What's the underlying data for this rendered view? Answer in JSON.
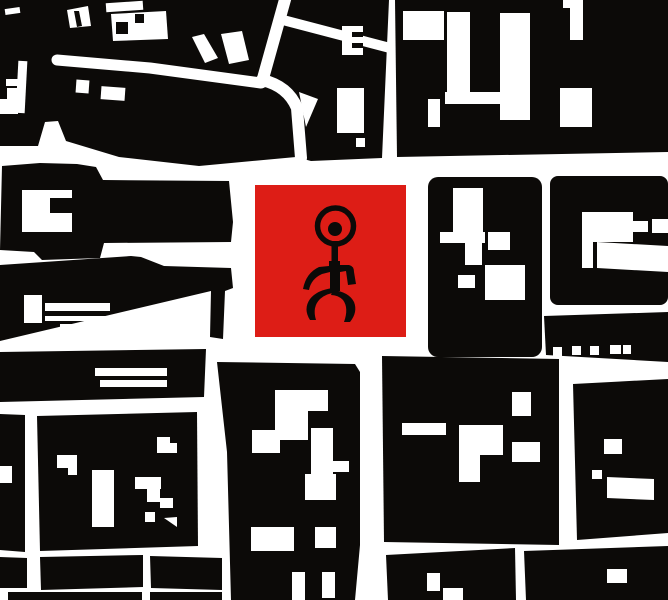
{
  "scene": {
    "width": 668,
    "height": 600,
    "background": "#ffffff",
    "ink": "#0c0a08",
    "marker_red": "#dd1d16",
    "description": "Black-and-white stylized city block map with red square marker bearing the Einstuerzende Neubauten stick-figure symbol"
  },
  "marker": {
    "x": 255,
    "y": 185,
    "w": 151,
    "h": 152
  },
  "map": {
    "blacks": [
      {
        "t": "p",
        "pts": "0,0 389,0 382,158 311,161 296,157 199,166 119,157 66,141 58,121 45,122 38,146 0,146"
      },
      {
        "t": "p",
        "pts": "395,0 668,0 668,152 397,157"
      },
      {
        "t": "p",
        "pts": "2,166 40,163 77,164 96,167 103,180 229,181 233,222 231,242 104,243 100,258 42,260 34,252 0,250"
      },
      {
        "t": "p",
        "pts": "0,265 131,256 141,257 164,266 231,268 233,288 225,291 223,339 210,337 211,291 0,341"
      },
      {
        "t": "p",
        "pts": "0,352 206,349 204,397 0,402"
      },
      {
        "t": "p",
        "pts": "0,414 25,415 25,552 0,550"
      },
      {
        "t": "p",
        "pts": "37,416 197,412 198,546 40,551"
      },
      {
        "t": "p",
        "pts": "40,557 143,555 143,587 41,590"
      },
      {
        "t": "p",
        "pts": "150,556 222,558 222,590 151,588"
      },
      {
        "t": "p",
        "pts": "0,557 27,558 27,588 0,588"
      },
      {
        "t": "r",
        "x": 8,
        "y": 592,
        "w": 134,
        "h": 8
      },
      {
        "t": "r",
        "x": 150,
        "y": 592,
        "w": 72,
        "h": 8
      },
      {
        "t": "p",
        "pts": "217,362 355,364 360,372 360,545 355,600 231,600 227,452"
      },
      {
        "t": "p",
        "pts": "382,356 559,359 559,545 384,542"
      },
      {
        "t": "p",
        "pts": "386,555 515,548 516,600 388,600"
      },
      {
        "t": "r",
        "x": 428,
        "y": 177,
        "w": 114,
        "h": 180,
        "rx": 10
      },
      {
        "t": "r",
        "x": 550,
        "y": 176,
        "w": 118,
        "h": 129,
        "rx": 8
      },
      {
        "t": "p",
        "pts": "544,316 668,312 668,362 546,355"
      },
      {
        "t": "p",
        "pts": "573,384 668,379 668,533 577,540"
      },
      {
        "t": "p",
        "pts": "524,551 668,546 668,600 526,600"
      }
    ],
    "whites": [
      {
        "t": "r",
        "x": 5,
        "y": 8,
        "w": 15,
        "h": 6,
        "rot": -8
      },
      {
        "t": "p",
        "pts": "67,10 88,6 91,26 70,28"
      },
      {
        "t": "r",
        "x": 106,
        "y": 2,
        "w": 37,
        "h": 9,
        "rot": -4
      },
      {
        "t": "p",
        "pts": "111,14 166,11 168,39 113,41"
      },
      {
        "t": "r",
        "x": 17,
        "y": 61,
        "w": 9,
        "h": 52,
        "rot": 3
      },
      {
        "t": "r",
        "x": 6,
        "y": 79,
        "w": 13,
        "h": 7
      },
      {
        "t": "r",
        "x": 7,
        "y": 88,
        "w": 16,
        "h": 13
      },
      {
        "t": "r",
        "x": 0,
        "y": 99,
        "w": 18,
        "h": 15
      },
      {
        "t": "s",
        "d": "M 57 60 L 150 68 L 261 83",
        "w": 11
      },
      {
        "t": "s",
        "d": "M 286 -4 L 262 82",
        "w": 12
      },
      {
        "t": "s",
        "d": "M 283 20 L 390 48",
        "w": 10
      },
      {
        "t": "s",
        "d": "M 262 80 Q 288 86 297 108 L 301 158",
        "w": 12
      },
      {
        "t": "p",
        "pts": "299,92 318,99 306,127"
      },
      {
        "t": "p",
        "pts": "192,37 204,34 218,58 205,63"
      },
      {
        "t": "p",
        "pts": "221,34 242,31 249,60 229,64"
      },
      {
        "t": "r",
        "x": 76,
        "y": 80,
        "w": 13,
        "h": 13,
        "rot": 4
      },
      {
        "t": "r",
        "x": 101,
        "y": 87,
        "w": 24,
        "h": 13,
        "rot": 4
      },
      {
        "t": "r",
        "x": 342,
        "y": 26,
        "w": 21,
        "h": 29
      },
      {
        "t": "r",
        "x": 337,
        "y": 88,
        "w": 27,
        "h": 45
      },
      {
        "t": "r",
        "x": 356,
        "y": 138,
        "w": 9,
        "h": 9
      },
      {
        "t": "r",
        "x": 403,
        "y": 11,
        "w": 41,
        "h": 29
      },
      {
        "t": "r",
        "x": 447,
        "y": 12,
        "w": 23,
        "h": 85
      },
      {
        "t": "r",
        "x": 445,
        "y": 92,
        "w": 65,
        "h": 12
      },
      {
        "t": "r",
        "x": 428,
        "y": 99,
        "w": 12,
        "h": 28
      },
      {
        "t": "r",
        "x": 500,
        "y": 13,
        "w": 30,
        "h": 107
      },
      {
        "t": "r",
        "x": 563,
        "y": 0,
        "w": 20,
        "h": 8
      },
      {
        "t": "r",
        "x": 570,
        "y": 8,
        "w": 13,
        "h": 32
      },
      {
        "t": "r",
        "x": 560,
        "y": 88,
        "w": 32,
        "h": 39
      },
      {
        "t": "p",
        "pts": "22,190 72,190 72,232 22,232"
      },
      {
        "t": "r",
        "x": 24,
        "y": 295,
        "w": 18,
        "h": 28
      },
      {
        "t": "r",
        "x": 45,
        "y": 303,
        "w": 65,
        "h": 8
      },
      {
        "t": "r",
        "x": 45,
        "y": 316,
        "w": 68,
        "h": 5
      },
      {
        "t": "r",
        "x": 60,
        "y": 324,
        "w": 38,
        "h": 4
      },
      {
        "t": "r",
        "x": 95,
        "y": 368,
        "w": 72,
        "h": 8
      },
      {
        "t": "r",
        "x": 100,
        "y": 380,
        "w": 67,
        "h": 7
      },
      {
        "t": "r",
        "x": 0,
        "y": 466,
        "w": 12,
        "h": 17
      },
      {
        "t": "p",
        "pts": "57,455 77,455 77,475 68,475 68,468 57,468"
      },
      {
        "t": "r",
        "x": 92,
        "y": 470,
        "w": 22,
        "h": 57
      },
      {
        "t": "r",
        "x": 135,
        "y": 477,
        "w": 26,
        "h": 12
      },
      {
        "t": "r",
        "x": 147,
        "y": 489,
        "w": 13,
        "h": 13
      },
      {
        "t": "r",
        "x": 145,
        "y": 512,
        "w": 10,
        "h": 10
      },
      {
        "t": "r",
        "x": 160,
        "y": 498,
        "w": 13,
        "h": 10
      },
      {
        "t": "p",
        "pts": "164,518 177,517 177,527"
      },
      {
        "t": "p",
        "pts": "157,437 170,437 170,443 177,443 177,453 157,453"
      },
      {
        "t": "r",
        "x": 252,
        "y": 430,
        "w": 28,
        "h": 23
      },
      {
        "t": "r",
        "x": 275,
        "y": 390,
        "w": 53,
        "h": 21
      },
      {
        "t": "r",
        "x": 275,
        "y": 411,
        "w": 33,
        "h": 29
      },
      {
        "t": "r",
        "x": 311,
        "y": 428,
        "w": 22,
        "h": 47
      },
      {
        "t": "r",
        "x": 333,
        "y": 461,
        "w": 16,
        "h": 11
      },
      {
        "t": "r",
        "x": 305,
        "y": 474,
        "w": 31,
        "h": 26
      },
      {
        "t": "r",
        "x": 251,
        "y": 527,
        "w": 43,
        "h": 24
      },
      {
        "t": "r",
        "x": 315,
        "y": 527,
        "w": 21,
        "h": 21
      },
      {
        "t": "r",
        "x": 292,
        "y": 572,
        "w": 13,
        "h": 28
      },
      {
        "t": "r",
        "x": 322,
        "y": 572,
        "w": 13,
        "h": 26
      },
      {
        "t": "r",
        "x": 402,
        "y": 423,
        "w": 44,
        "h": 12
      },
      {
        "t": "p",
        "pts": "459,425 503,425 503,455 480,455 480,482 459,482"
      },
      {
        "t": "r",
        "x": 512,
        "y": 392,
        "w": 19,
        "h": 24
      },
      {
        "t": "r",
        "x": 512,
        "y": 442,
        "w": 28,
        "h": 20
      },
      {
        "t": "r",
        "x": 427,
        "y": 573,
        "w": 13,
        "h": 18
      },
      {
        "t": "r",
        "x": 443,
        "y": 588,
        "w": 20,
        "h": 12
      },
      {
        "t": "r",
        "x": 453,
        "y": 188,
        "w": 30,
        "h": 46
      },
      {
        "t": "r",
        "x": 440,
        "y": 232,
        "w": 45,
        "h": 11
      },
      {
        "t": "r",
        "x": 465,
        "y": 243,
        "w": 17,
        "h": 22
      },
      {
        "t": "r",
        "x": 488,
        "y": 232,
        "w": 22,
        "h": 18
      },
      {
        "t": "r",
        "x": 485,
        "y": 265,
        "w": 40,
        "h": 35
      },
      {
        "t": "r",
        "x": 458,
        "y": 275,
        "w": 17,
        "h": 13
      },
      {
        "t": "r",
        "x": 582,
        "y": 212,
        "w": 51,
        "h": 30
      },
      {
        "t": "r",
        "x": 633,
        "y": 221,
        "w": 15,
        "h": 11
      },
      {
        "t": "r",
        "x": 652,
        "y": 219,
        "w": 16,
        "h": 14
      },
      {
        "t": "r",
        "x": 582,
        "y": 242,
        "w": 11,
        "h": 26
      },
      {
        "t": "p",
        "pts": "597,242 668,246 668,272 597,268"
      },
      {
        "t": "r",
        "x": 553,
        "y": 347,
        "w": 9,
        "h": 9
      },
      {
        "t": "r",
        "x": 572,
        "y": 346,
        "w": 9,
        "h": 9
      },
      {
        "t": "r",
        "x": 590,
        "y": 346,
        "w": 9,
        "h": 9
      },
      {
        "t": "r",
        "x": 610,
        "y": 345,
        "w": 11,
        "h": 9
      },
      {
        "t": "r",
        "x": 623,
        "y": 345,
        "w": 8,
        "h": 9
      },
      {
        "t": "r",
        "x": 604,
        "y": 439,
        "w": 18,
        "h": 15
      },
      {
        "t": "p",
        "pts": "607,477 654,479 654,500 607,498"
      },
      {
        "t": "r",
        "x": 592,
        "y": 470,
        "w": 10,
        "h": 9
      },
      {
        "t": "r",
        "x": 607,
        "y": 569,
        "w": 20,
        "h": 14
      }
    ],
    "black_details": [
      {
        "t": "p",
        "pts": "74,11 79,11 82,26 77,27"
      },
      {
        "t": "r",
        "x": 116,
        "y": 22,
        "w": 12,
        "h": 12
      },
      {
        "t": "r",
        "x": 135,
        "y": 14,
        "w": 9,
        "h": 9
      },
      {
        "t": "r",
        "x": 352,
        "y": 32,
        "w": 11,
        "h": 5
      },
      {
        "t": "r",
        "x": 352,
        "y": 43,
        "w": 11,
        "h": 5
      },
      {
        "t": "r",
        "x": 50,
        "y": 198,
        "w": 22,
        "h": 15
      }
    ]
  },
  "logo": {
    "head": {
      "cx": 335.5,
      "cy": 226,
      "r": 18,
      "stroke_w": 5.5
    },
    "eye": {
      "cx": 335,
      "cy": 229,
      "r": 7
    },
    "neck": {
      "x": 331.5,
      "y": 241,
      "w": 6.5,
      "h": 24
    },
    "paths": [
      "M 303 289 Q 306 273 319 267 L 329 266 L 329 261 L 340 261 L 340 265 L 349 265 Q 354 266 354 272 L 356 284 L 348 285 L 346 271 L 340 272 L 340 291 L 330 291 L 330 272 L 322 274 Q 311 279 309 290 Z",
      "M 333 288 Q 317 290 310 299 Q 303 309 310 320 L 316 320 Q 312 307 320 299 Q 327 293 335 293 Z",
      "M 333 290 Q 349 292 354 302 Q 358 312 350 322 L 344 322 Q 349 308 343 300 Q 338 295 331 295 Z"
    ]
  }
}
